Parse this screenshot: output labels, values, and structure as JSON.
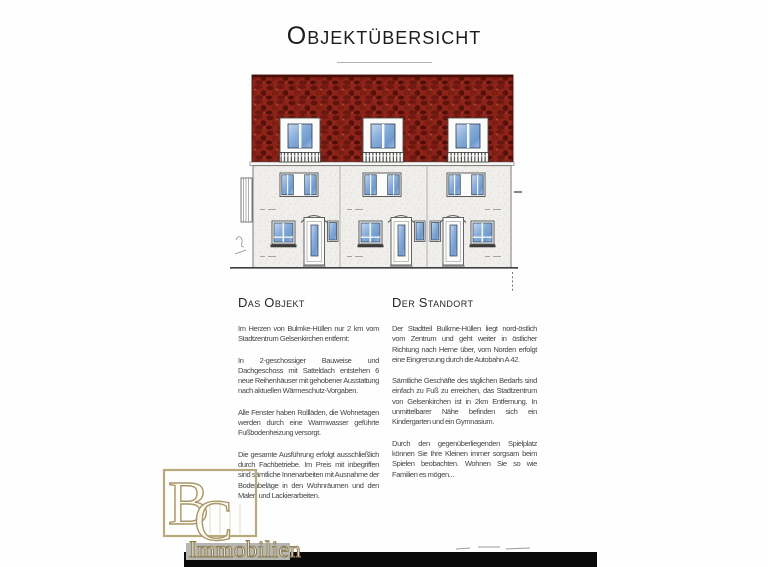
{
  "title": "Objektübersicht",
  "left_column": {
    "heading": "Das Objekt",
    "paragraphs": [
      "Im Herzen von Bulmke-Hüllen nur 2 km vom Stadtzentrum Gelsenkirchen entfernt:",
      "In 2-geschossiger Bauweise und Dachgeschoss mit Satteldach entstehen 6 neue Reihenhäuser mit gehobener Ausstattung nach aktuellen Wärmeschutz-Vorgaben.",
      "Alle Fenster haben Rollläden, die Wohnetagen werden durch eine Warmwasser geführte Fußbodenheizung versorgt.",
      "Die gesamte Ausführung erfolgt ausschließlich durch Fachbetriebe. Im Preis mit inbegriffen sind sämtliche Innenarbeiten mit Ausnahme der Bodenbeläge in den Wohnräumen und den Maler- und Lackierarbeiten."
    ]
  },
  "right_column": {
    "heading": "Der Standort",
    "paragraphs": [
      "Der Stadtteil Bulkme-Hüllen liegt nord-östlich vom Zentrum und geht weiter in östlicher Richtung nach Herne über, vom Norden erfolgt eine Eingrenzung durch die Autobahn A 42.",
      "Sämtliche Geschäfte des täglichen Bedarfs sind einfach zu Fuß zu erreichen, das Stadtzentrum von Gelsenkirchen ist in 2km Entfernung. In unmittelbarer Nähe befinden sich ein Kindergarten und ein Gymnasium.",
      "Durch den gegenüberliegenden Spielplatz können Sie Ihre Kleinen immer sorgsam beim Spielen beobachten. Wohnen Sie so wie Familien es mögen..."
    ]
  },
  "drawing": {
    "subject": "front-elevation-of-6-terraced-houses",
    "roof_color": "#8e2419",
    "roof_shadow_color": "#5c120b",
    "facade_color": "#efeeeb",
    "window_glass_color": "#84abd9",
    "frame_color": "#fcfcfa"
  },
  "watermark": {
    "monogram_letter_1": "B",
    "monogram_letter_2": "C",
    "caption": "Immobilien",
    "gold_color": "#a79667"
  },
  "footer": {
    "bar_color": "#0a0a0a"
  }
}
